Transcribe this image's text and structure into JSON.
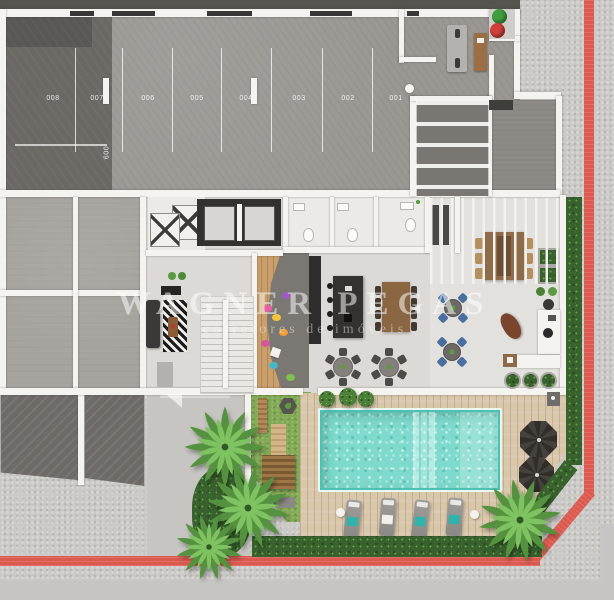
{
  "watermark": {
    "line1": "WAGNER PEGAS",
    "line2": "corretores de imóveis"
  },
  "parking": {
    "spaces": [
      "008",
      "007",
      "006",
      "005",
      "004",
      "003",
      "002",
      "001"
    ],
    "side_space": "009"
  },
  "colors": {
    "curb_line": "#dd5a50",
    "pool_water": "#7edacc",
    "deck_wood": "#d9c7ab",
    "lawn": "#83aa55",
    "hedge": "#39612e",
    "palm": "#7fc261",
    "umbrella": "#3b3835",
    "garage_dark_floor": "#6c6965",
    "garage_floor": "#9b9793",
    "interior_floor": "#dcdad6",
    "kids_wood": "#c99f6b",
    "wall": "#f4f3f0",
    "bin_green": "#3f9e3f",
    "bin_red": "#cf4038",
    "sidewalk": "#cbc9c6",
    "water_chair_blue": "#4a6e9e"
  },
  "scene": {
    "type": "top-down architectural floor plan render",
    "areas": [
      "garage-parking",
      "vehicle-ramp",
      "service-rooms",
      "elevators",
      "emergency-stairs",
      "restrooms",
      "lounge",
      "kids-space",
      "gourmet-kitchen",
      "covered-dining-terrace",
      "reception",
      "garden",
      "pool-deck",
      "swimming-pool",
      "sidewalk-with-red-curb"
    ]
  }
}
